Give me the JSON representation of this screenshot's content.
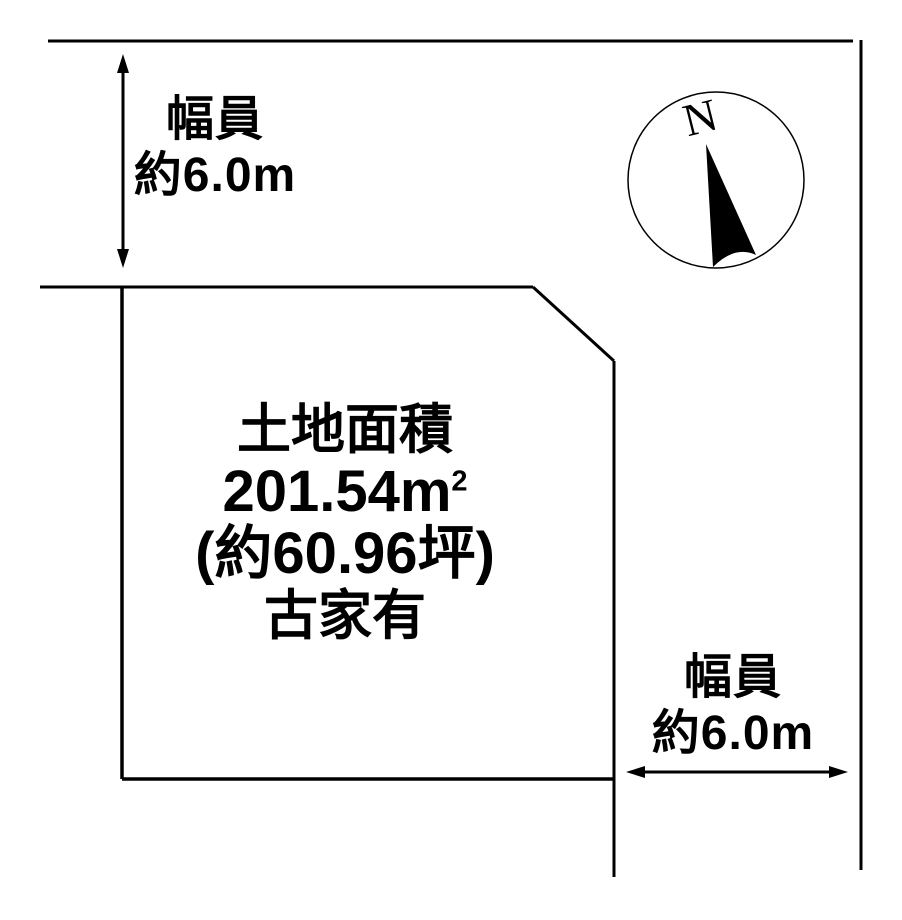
{
  "diagram": {
    "background_color": "#ffffff",
    "ink_color": "#000000",
    "type": "land-parcel-plan"
  },
  "parcel": {
    "area_title": "土地面積",
    "area_m2_value": "201.54m",
    "area_m2_superscript": "2",
    "area_tsubo": "(約60.96坪)",
    "building_note": "古家有"
  },
  "road_top": {
    "label_line1": "幅員",
    "label_line2": "約6.0m"
  },
  "road_right": {
    "label_line1": "幅員",
    "label_line2": "約6.0m"
  },
  "compass": {
    "north_label": "N"
  }
}
